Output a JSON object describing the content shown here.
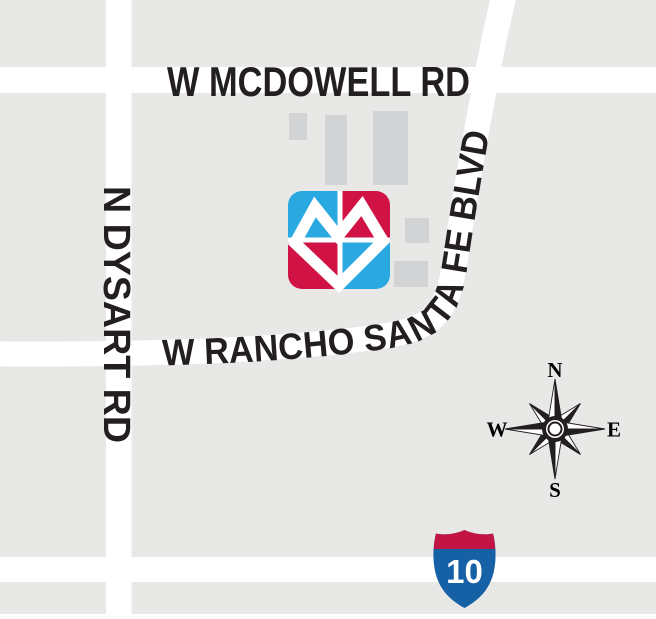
{
  "map": {
    "colors": {
      "background": "#e8e8e7",
      "road": "#ffffff",
      "building": "#d2d3d4",
      "label": "#231f20"
    },
    "road_labels": {
      "mcdowell": "W MCDOWELL RD",
      "dysart": "N DYSART RD",
      "rancho_santa_fe": "W RANCHO SANTA FE BLVD"
    },
    "compass": {
      "north": "N",
      "east": "E",
      "south": "S",
      "west": "W"
    },
    "interstate_shield": {
      "route_number": "10",
      "crest_red": "#c31543",
      "body_blue": "#1660a5",
      "number_color": "#ffffff"
    },
    "location_logo": {
      "quadrant_blue": "#29a9e0",
      "quadrant_red": "#d11245",
      "heart_color": "#ffffff"
    }
  }
}
